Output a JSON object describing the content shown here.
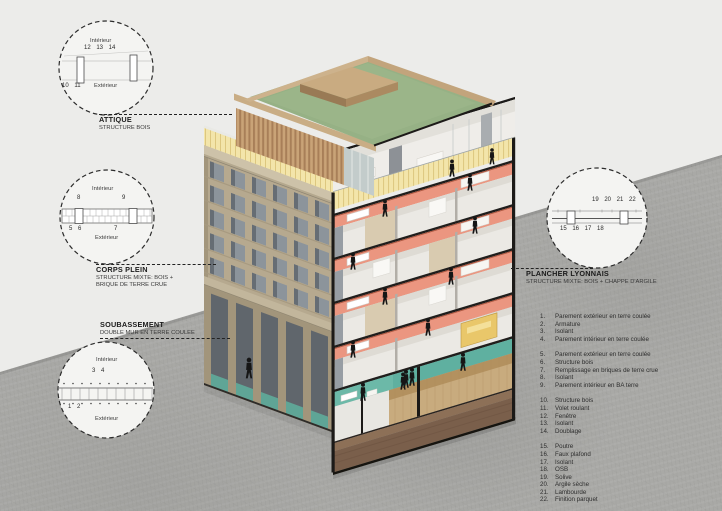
{
  "diagram_title_hint": "Axonometric cutaway of a mixed wood / raw-earth building with construction detail callouts",
  "palette": {
    "paper": "#ececea",
    "concrete_grey": "#a9a9a6",
    "facade_beige": "#b6a98f",
    "floor_salmon": "#eb9680",
    "ground_teal": "#5fb0a0",
    "terrace_yellow": "#f3e5aa",
    "roof_green": "#96b185",
    "wood_tan": "#c9a377",
    "basement_brown": "#7a5f4b",
    "cut_black": "#1c1a18"
  },
  "detail_circles": {
    "attique": {
      "interior": "Intérieur",
      "exterior": "Extérieur",
      "top_numbers": "12 13 14",
      "bottom_numbers": "10 11"
    },
    "corps_plein": {
      "interior": "Intérieur",
      "exterior": "Extérieur",
      "left_number": "8",
      "right_number": "9",
      "bottom_left_numbers": "5 6",
      "bottom_right_number": "7"
    },
    "soubassement": {
      "interior": "Intérieur",
      "exterior": "Extérieur",
      "top_numbers": "3 4",
      "bottom_numbers": "1 2"
    },
    "plancher_lyonnais": {
      "top_numbers": "19 20 21 22",
      "bottom_numbers": "15 16 17 18"
    }
  },
  "callouts": {
    "attique": {
      "title": "ATTIQUE",
      "subtitle": "STRUCTURE BOIS"
    },
    "corps_plein": {
      "title": "CORPS PLEIN",
      "subtitle_line1": "STRUCTURE MIXTE: BOIS +",
      "subtitle_line2": "BRIQUE DE TERRE CRUE"
    },
    "soubassement": {
      "title": "SOUBASSEMENT",
      "subtitle": "DOUBLE MUR EN TERRE COULEE"
    },
    "plancher_lyonnais": {
      "title": "PLANCHER LYONNAIS",
      "subtitle": "STRUCTURE MIXTE: BOIS + CHAPPE D'ARGILE"
    }
  },
  "legend": {
    "items": [
      {
        "num": "1.",
        "text": "Parement extérieur en terre coulée"
      },
      {
        "num": "2.",
        "text": "Armature"
      },
      {
        "num": "3.",
        "text": "Isolant"
      },
      {
        "num": "4.",
        "text": "Parement intérieur en terre coulée"
      },
      {
        "num": "5.",
        "text": "Parement extérieur en terre coulée"
      },
      {
        "num": "6.",
        "text": "Structure bois"
      },
      {
        "num": "7.",
        "text": "Remplissage en briques de terre crue"
      },
      {
        "num": "8.",
        "text": "Isolant"
      },
      {
        "num": "9.",
        "text": "Parement intérieur en BA terre"
      },
      {
        "num": "10.",
        "text": "Structure bois"
      },
      {
        "num": "11.",
        "text": "Volet roulant"
      },
      {
        "num": "12.",
        "text": "Fenêtre"
      },
      {
        "num": "13.",
        "text": "Isolant"
      },
      {
        "num": "14.",
        "text": "Doublage"
      },
      {
        "num": "15.",
        "text": "Poutre"
      },
      {
        "num": "16.",
        "text": "Faux plafond"
      },
      {
        "num": "17.",
        "text": "Isolant"
      },
      {
        "num": "18.",
        "text": "OSB"
      },
      {
        "num": "19.",
        "text": "Solive"
      },
      {
        "num": "20.",
        "text": "Argile sèche"
      },
      {
        "num": "21.",
        "text": "Lambourde"
      },
      {
        "num": "22.",
        "text": "Finition parquet"
      }
    ]
  }
}
